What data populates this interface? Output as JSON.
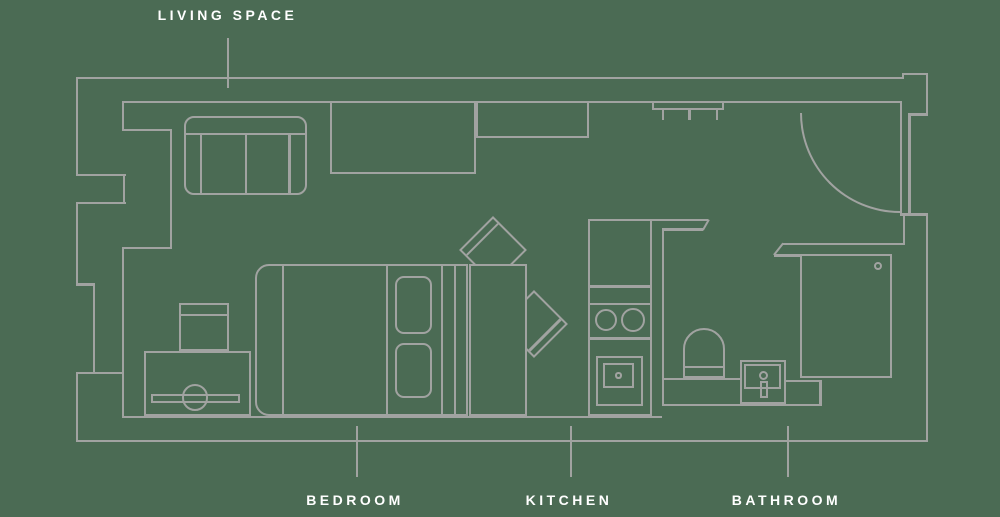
{
  "diagram": {
    "type": "apartment-floor-plan",
    "rooms": [
      "LIVING SPACE",
      "BEDROOM",
      "KITCHEN",
      "BATHROOM"
    ]
  },
  "labels": {
    "living_space": {
      "text": "LIVING SPACE"
    },
    "bedroom": {
      "text": "BEDROOM"
    },
    "kitchen": {
      "text": "KITCHEN"
    },
    "bathroom": {
      "text": "BATHROOM"
    }
  },
  "colors": {
    "background": "#4b6b54",
    "line": "#a1a3a1",
    "label": "#ffffff"
  }
}
